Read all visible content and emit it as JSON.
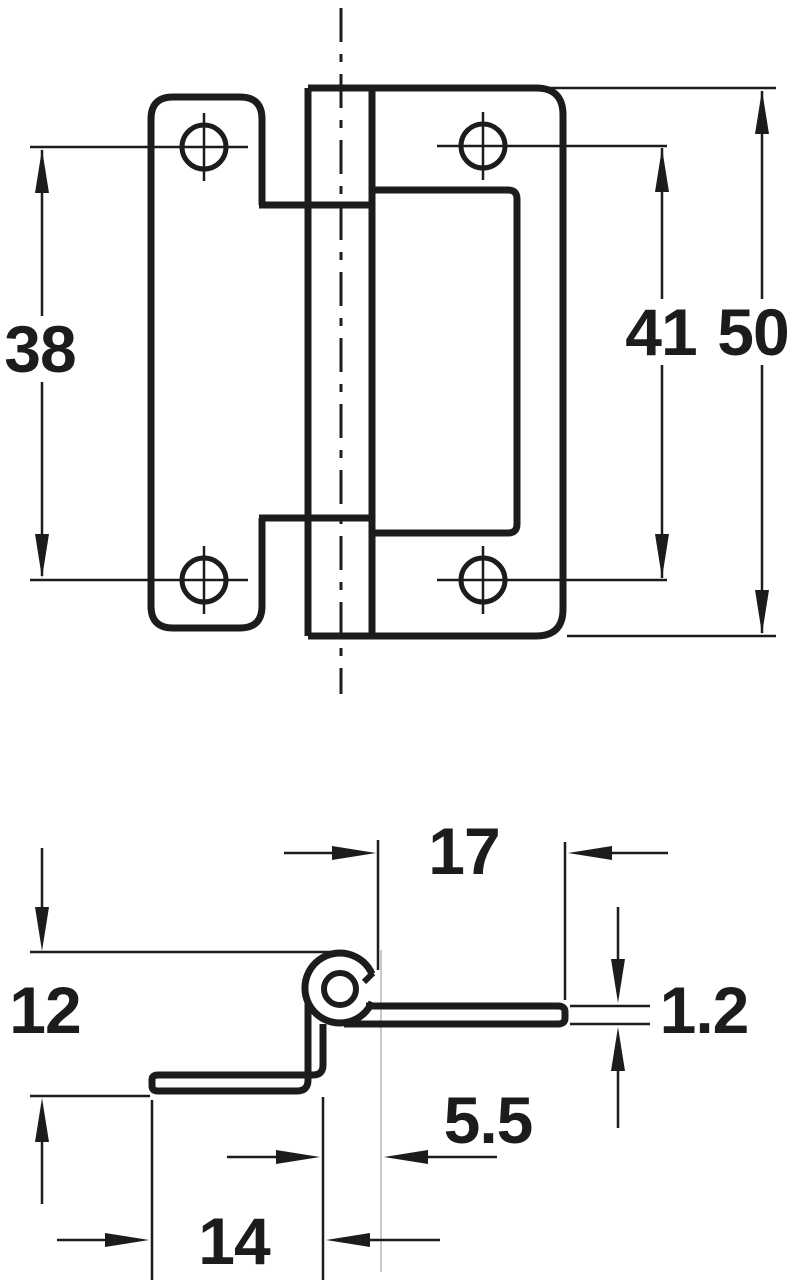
{
  "page": {
    "background": "#ffffff"
  },
  "drawing": {
    "type": "technical-dimension-drawing",
    "subject": "cranked flush hinge, two orthographic views",
    "line_color": "#1c1c1c",
    "centerline_color": "#c9c9c9",
    "views": [
      {
        "id": "front",
        "name": "front elevation with knuckle centerline, four screw holes and recess cutout"
      },
      {
        "id": "profile",
        "name": "cross-section profile with curled knuckle and cranked leaf"
      }
    ],
    "dimensions": {
      "front_hole_spacing_left": "38",
      "front_hole_spacing_right": "41",
      "front_overall_height": "50",
      "profile_leaf_length": "17",
      "profile_crank_depth": "12",
      "profile_material_thickness": "1.2",
      "profile_knuckle_offset": "5.5",
      "profile_cranked_leaf_length": "14"
    }
  }
}
